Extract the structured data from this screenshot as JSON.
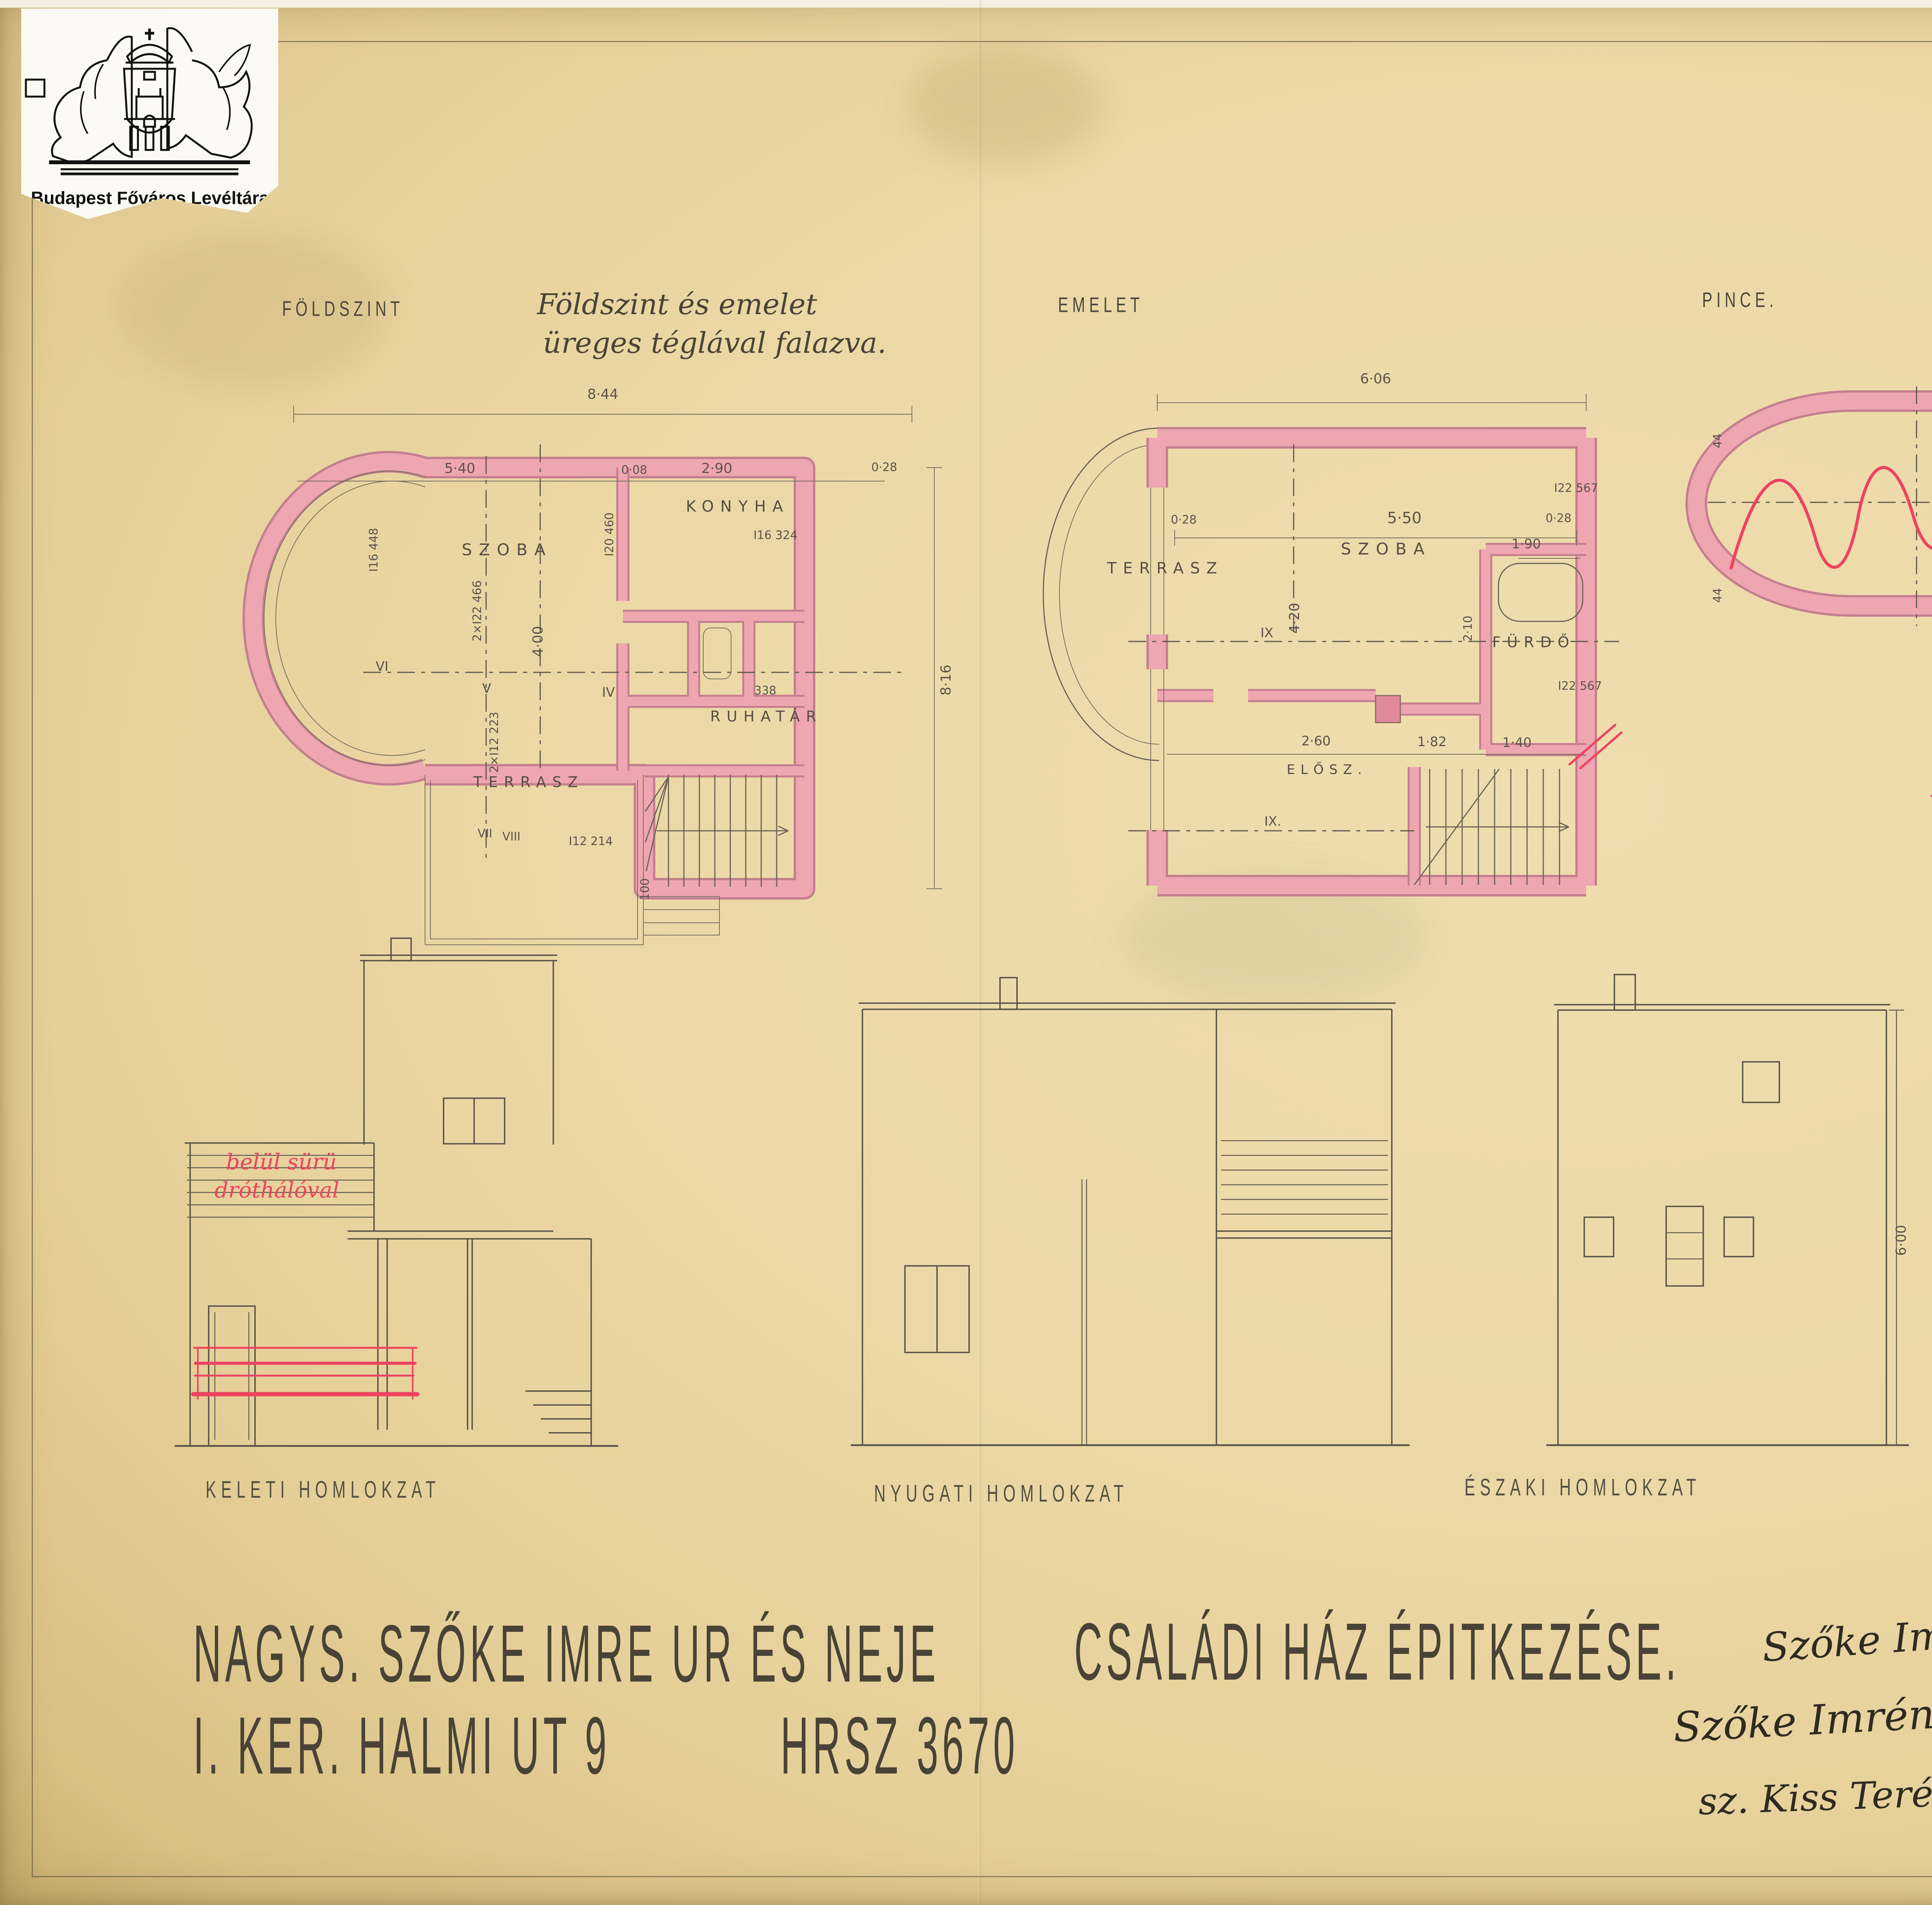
{
  "archive": {
    "label": "Budapest Főváros Levéltára"
  },
  "header": {
    "foldszint": "FÖLDSZINT",
    "note1": "Földszint és emelet",
    "note2": "üreges téglával falazva.",
    "emelet": "EMELET",
    "pince": "PINCE.",
    "metszet": "METSZET",
    "red_note": "hő és nedvesség szigeteléssel"
  },
  "foldszint": {
    "szoba": "SZOBA",
    "konyha": "KONYHA",
    "ruhatar": "RUHATÁR",
    "terrasz": "TERRASZ",
    "d844": "8·44",
    "d816": "8·16",
    "d540": "5·40",
    "d290": "2·90",
    "d008": "0·08",
    "d028": "0·28",
    "d400": "4·00",
    "i16448": "I16 448",
    "i22466": "2×I22 466",
    "i20460": "I20 460",
    "i16324": "I16 324",
    "d338": "338",
    "i12223": "2×I12 223",
    "i12214": "I12 214",
    "d100": "100",
    "rvi": "VI",
    "rv": "V",
    "riv": "IV",
    "rvii": "VII",
    "rviii": "VIII"
  },
  "emelet": {
    "terrasz": "TERRASZ",
    "szoba": "SZOBA",
    "furdo": "FÜRDŐ",
    "elosz": "ELŐSZ.",
    "d606": "6·06",
    "d550": "5·50",
    "d028a": "0·28",
    "d028b": "0·28",
    "d420": "4·20",
    "d190": "1·90",
    "d210": "2·10",
    "i22a": "I22 567",
    "i22b": "I22 567",
    "d260": "2·60",
    "d182": "1·82",
    "d140": "1·40",
    "ix1": "IX",
    "ix2": "IX."
  },
  "pince": {
    "tuzelo": "TÜZELŐ",
    "d270": "2·70",
    "d028": "0·28",
    "d041": "0·41",
    "d300": "3·00",
    "i14a": "I14 312",
    "i14b": "I14 312",
    "x1": "X",
    "x2": "X",
    "d044a": "44",
    "d044b": "44",
    "d090": "90"
  },
  "metszet": {
    "d270": "2·70",
    "d280": "2·80",
    "d540": "5·40",
    "d008": "0·08",
    "d290": "2·90",
    "p310": "+3·10",
    "d690": "6·90",
    "pm000": "±0·00",
    "m080": "−0·80",
    "d320": "3·20"
  },
  "elevations": {
    "keleti": "KELETI HOMLOKZAT",
    "nyugati": "NYUGATI HOMLOKZAT",
    "eszaki": "ÉSZAKI HOMLOKZAT",
    "deli": "DÉLI HOMLOKZAT",
    "red1": "belül sürü",
    "red2": "dróthálóval",
    "d600": "6·00"
  },
  "title": {
    "l1a": "NAGYS.  SZŐKE IMRE UR ÉS NEJE",
    "l1b": "CSALÁDI HÁZ ÉPITKEZÉSE.",
    "l2a": "I. KER.  HALMI UT 9",
    "l2b": "HRSZ 3670"
  },
  "signatures": {
    "s1": "Szőke Imre",
    "s2": "Szőke Imréné",
    "s3": "sz. Kiss Teréz"
  },
  "stamp": {
    "name": "BÁLINT és SÁNDORI",
    "role": "épitészek",
    "address": "Budapest, VII., Király-u. 51.",
    "phone": "Tel. Józs. 428-92.",
    "signature": "Bálint Sándor"
  },
  "date": {
    "text": "BUDAPEST_ 1932 DECEMBER HÓ_"
  }
}
